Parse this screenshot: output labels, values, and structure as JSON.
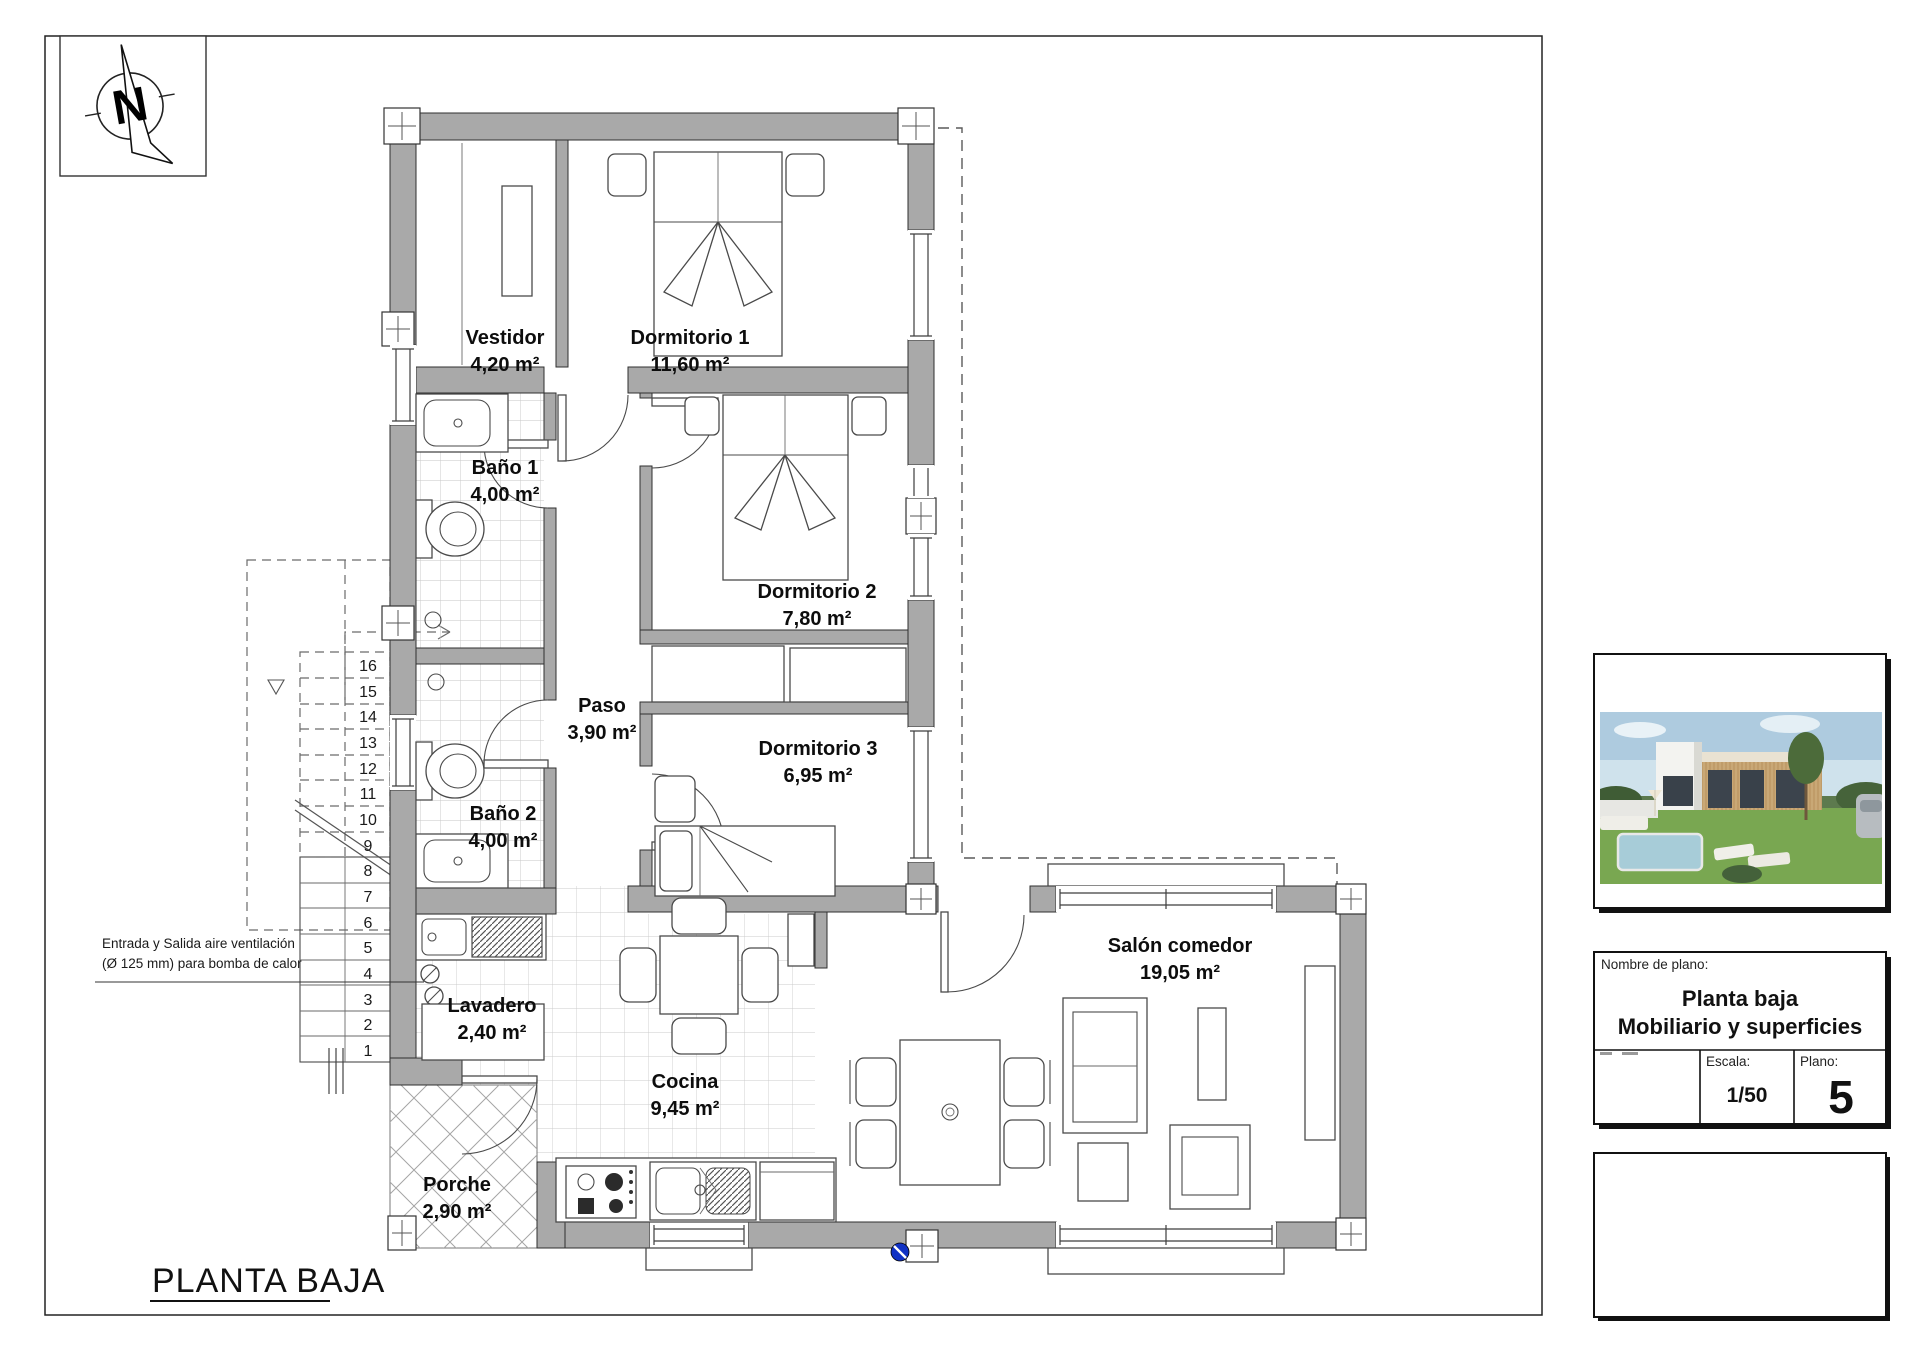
{
  "sheet": {
    "plan_title": "PLANTA BAJA",
    "annotation": {
      "line1": "Entrada y Salida aire ventilación",
      "line2": "(Ø 125 mm) para bomba de calor"
    }
  },
  "compass": {
    "label": "N"
  },
  "rooms": [
    {
      "name": "Vestidor",
      "area": "4,20 m²"
    },
    {
      "name": "Dormitorio 1",
      "area": "11,60 m²"
    },
    {
      "name": "Baño 1",
      "area": "4,00 m²"
    },
    {
      "name": "Dormitorio 2",
      "area": "7,80 m²"
    },
    {
      "name": "Paso",
      "area": "3,90 m²"
    },
    {
      "name": "Dormitorio 3",
      "area": "6,95 m²"
    },
    {
      "name": "Baño 2",
      "area": "4,00 m²"
    },
    {
      "name": "Lavadero",
      "area": "2,40 m²"
    },
    {
      "name": "Cocina",
      "area": "9,45 m²"
    },
    {
      "name": "Porche",
      "area": "2,90 m²"
    },
    {
      "name": "Salón comedor",
      "area": "19,05 m²"
    }
  ],
  "stairs": {
    "steps": [
      "1",
      "2",
      "3",
      "4",
      "5",
      "6",
      "7",
      "8",
      "9",
      "10",
      "11",
      "12",
      "13",
      "14",
      "15",
      "16"
    ]
  },
  "title_block": {
    "name_label": "Nombre de plano:",
    "title_line1": "Planta baja",
    "title_line2": "Mobiliario y superficies",
    "scale_label": "Escala:",
    "scale_value": "1/50",
    "plan_label": "Plano:",
    "plan_number": "5"
  },
  "colors": {
    "wall": "#a9a9a9",
    "marker_blue": "#1031c4"
  }
}
